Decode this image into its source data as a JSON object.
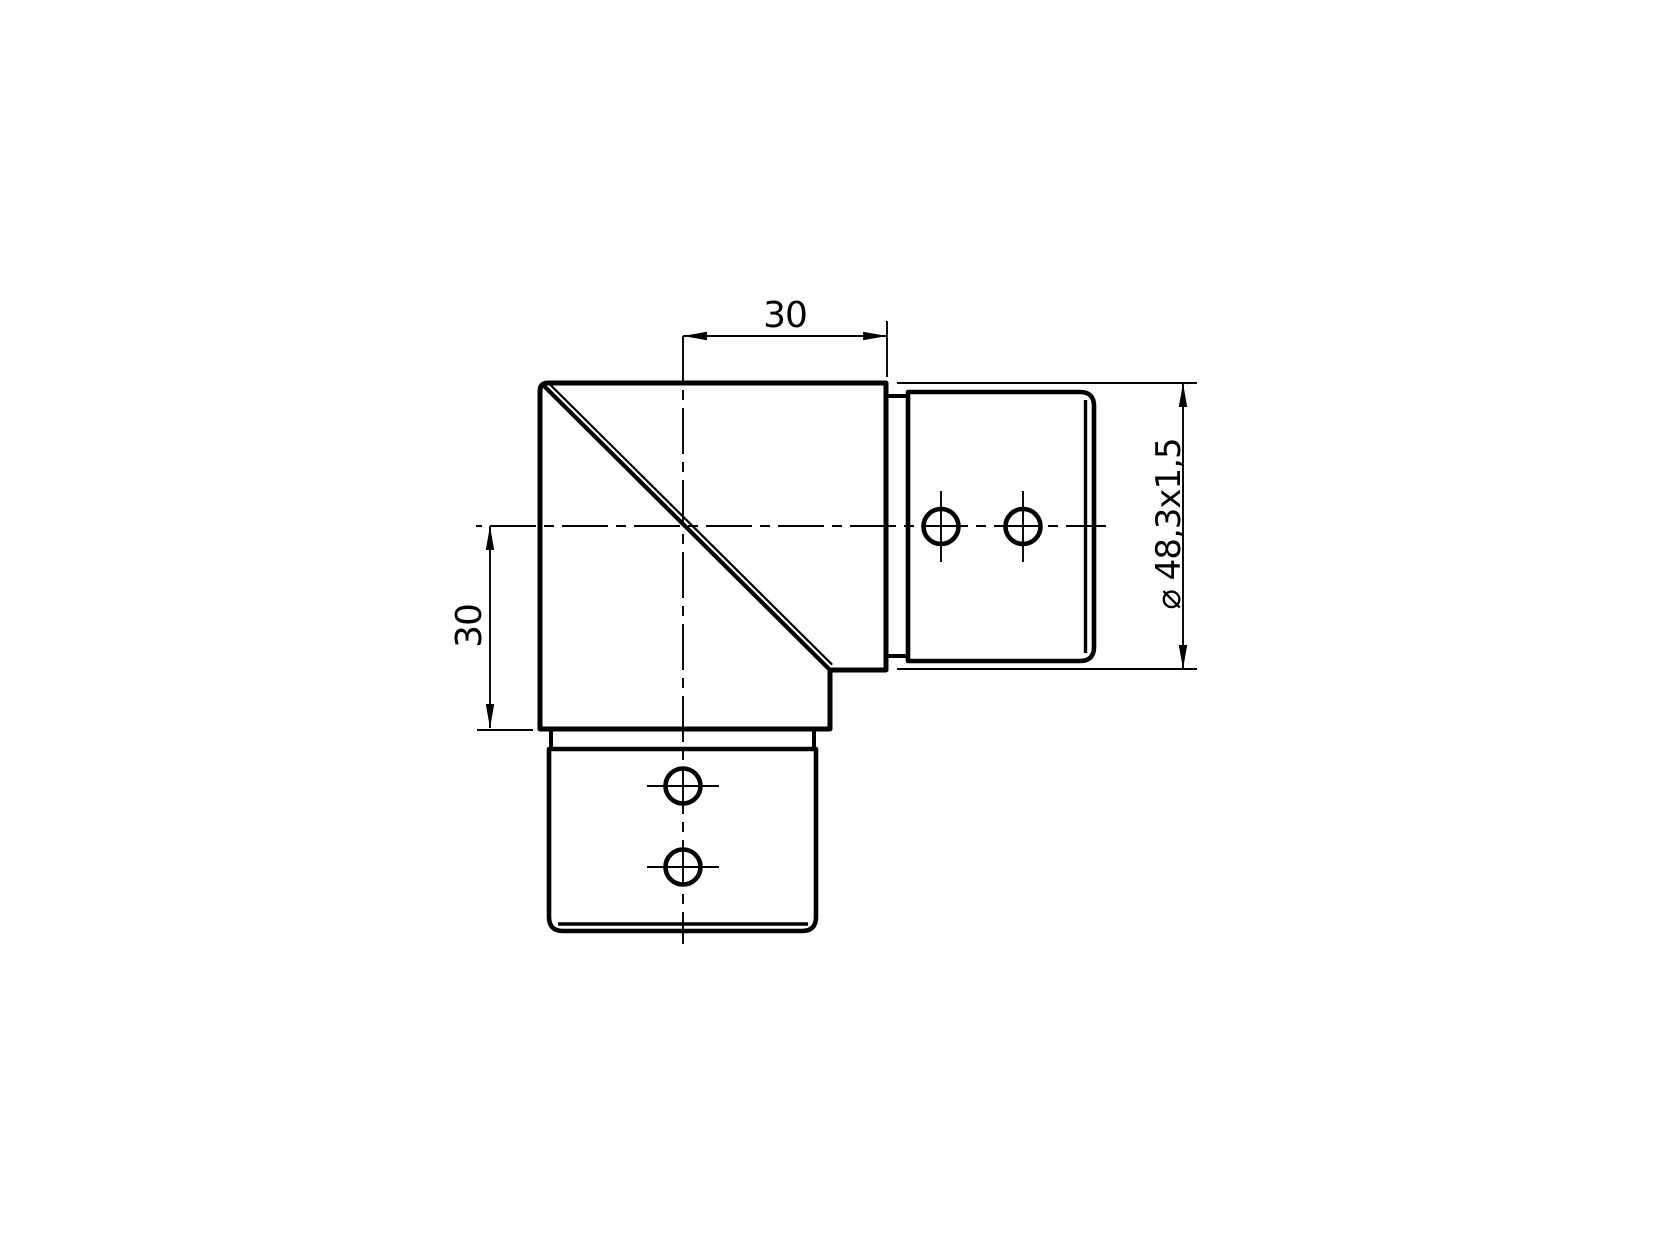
{
  "canvas": {
    "background_color": "#ffffff",
    "line_color": "#000000"
  },
  "drawing": {
    "type": "technical-drawing",
    "view": "elbow-fitting-side-view"
  },
  "labels": {
    "dim_horizontal_offset": "30",
    "dim_vertical_offset": "30",
    "dim_tube_spec": "⌀ 48,3x1,5"
  }
}
